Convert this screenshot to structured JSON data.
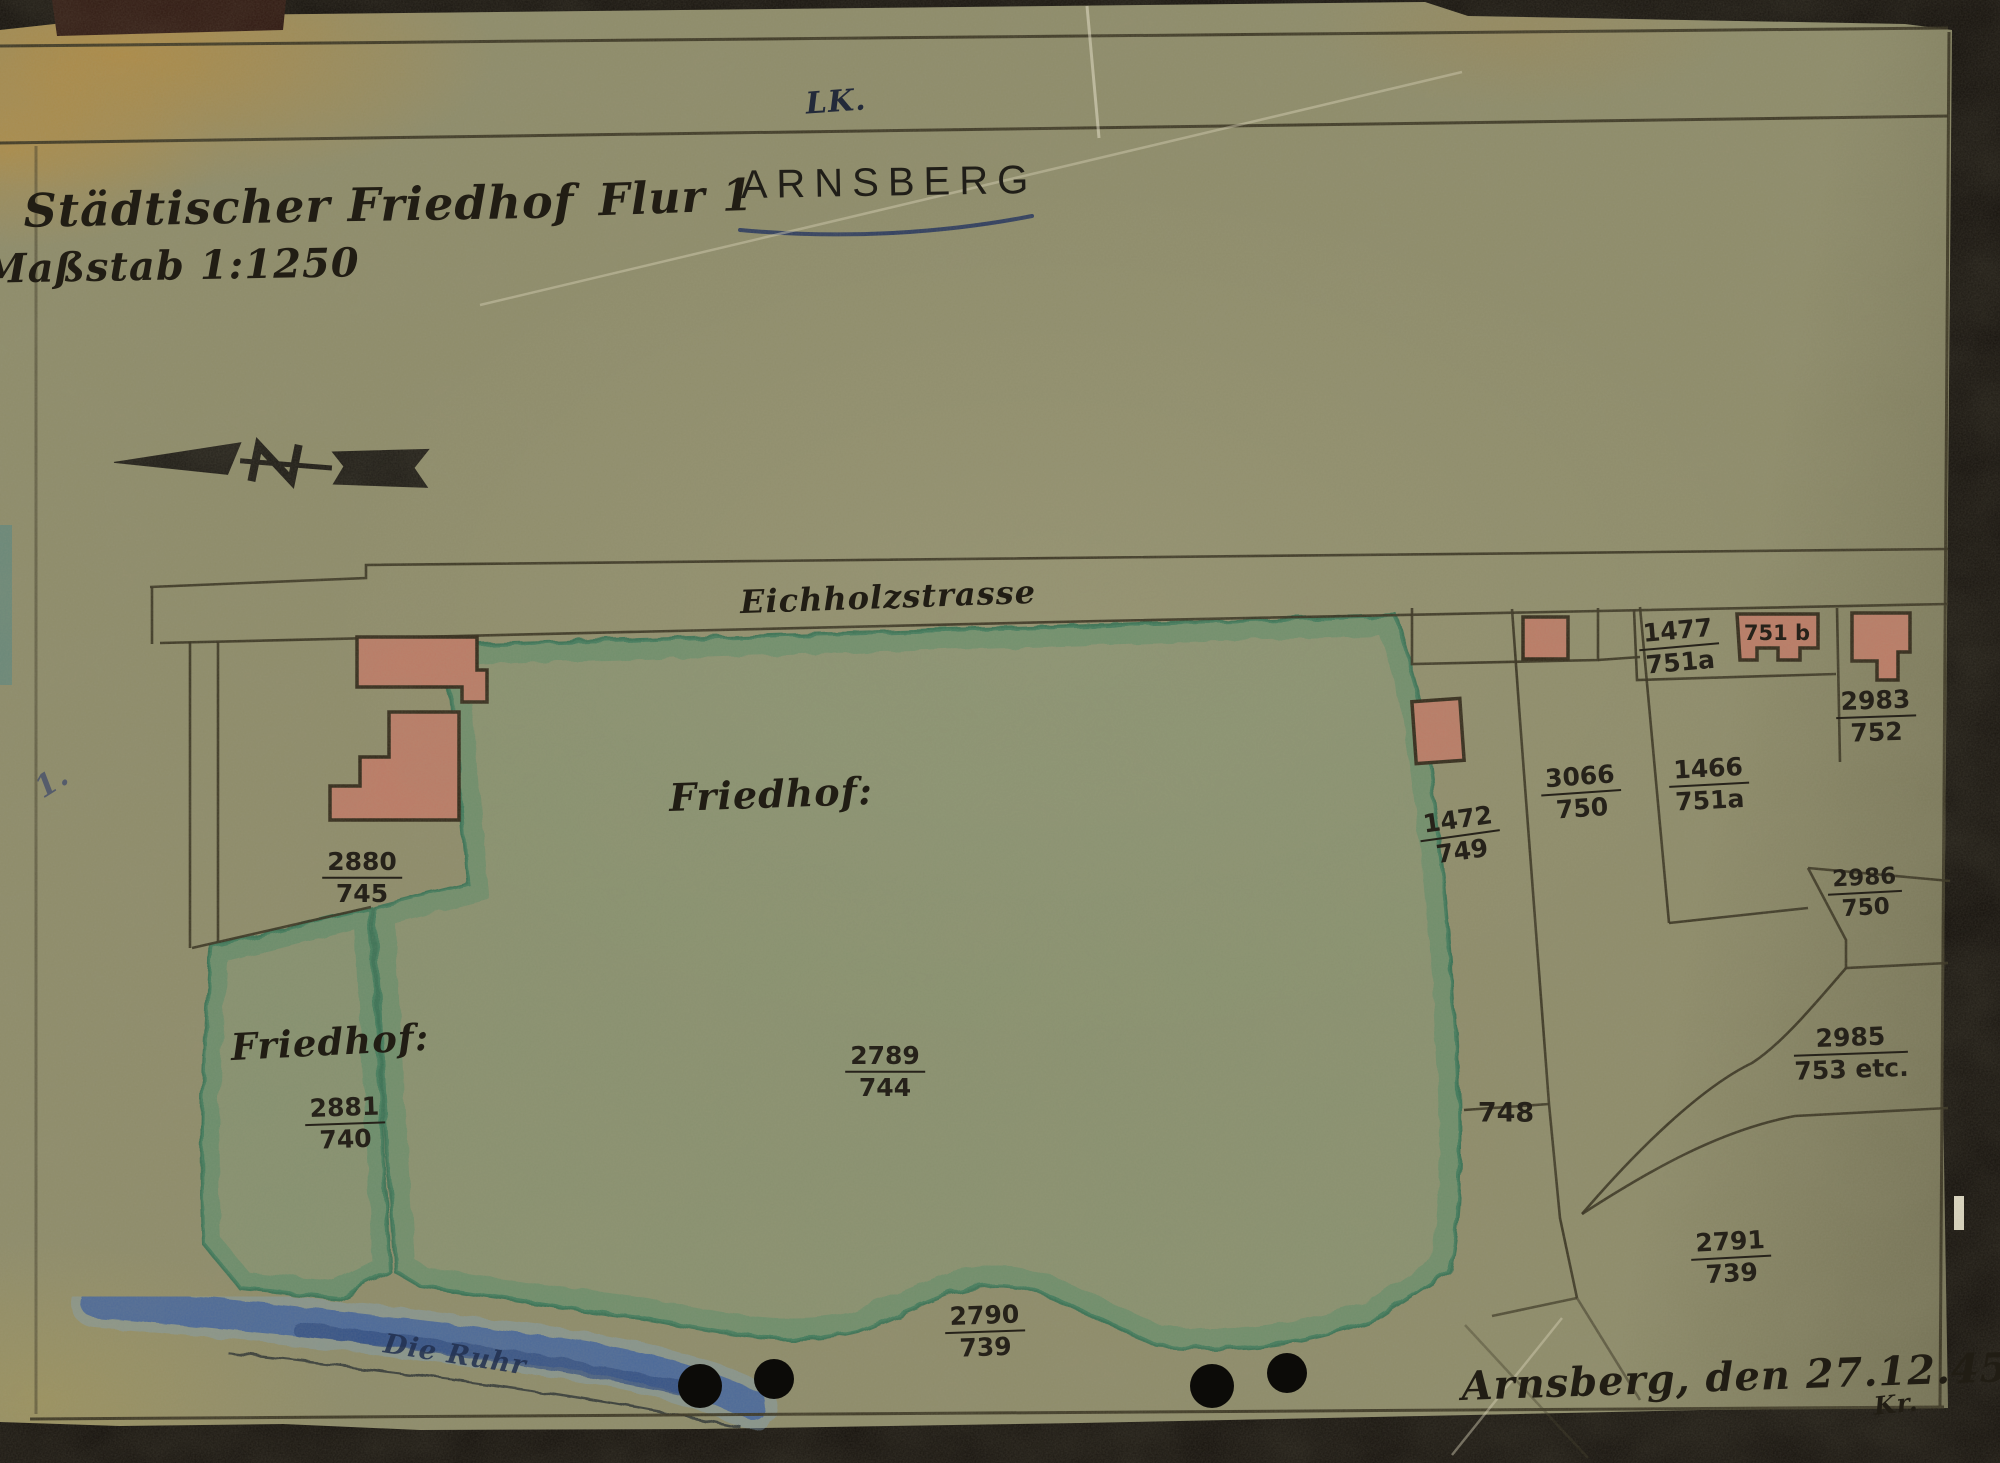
{
  "header": {
    "lk": "LK.",
    "title": "Städtischer Friedhof",
    "scale": "Maßstab 1:1250",
    "flur": "Flur 1",
    "place": "ARNSBERG"
  },
  "map": {
    "street": "Eichholzstrasse",
    "cemetery_label_main": "Friedhof:",
    "cemetery_label_left": "Friedhof:",
    "river": "Die Ruhr",
    "margin_note": "1.",
    "parcels": [
      {
        "num": "2880",
        "den": "745"
      },
      {
        "num": "2881",
        "den": "740"
      },
      {
        "num": "2789",
        "den": "744"
      },
      {
        "num": "2790",
        "den": "739"
      },
      {
        "num": "1472",
        "den": "749"
      },
      {
        "num": "3066",
        "den": "750"
      },
      {
        "num": "1466",
        "den": "751a"
      },
      {
        "num": "1477",
        "den": "751a"
      },
      {
        "num": "2983",
        "den": "752"
      },
      {
        "num": "2986",
        "den": "750"
      },
      {
        "num": "2985",
        "den": "753 etc."
      },
      {
        "num": "2791",
        "den": "739"
      }
    ],
    "plain_labels": [
      {
        "text": "748"
      },
      {
        "text": "751 b"
      }
    ]
  },
  "footer": {
    "date_line": "Arnsberg, den 27.12.45",
    "initials": "Kr."
  },
  "colors": {
    "paper": "#8e8c6a",
    "ink": "#2e2a1e",
    "building_red": "#bd7b66",
    "cemetery_green": "#3f7d5d",
    "river_blue": "#3c5f9f",
    "stain_orange": "#c08a34"
  }
}
